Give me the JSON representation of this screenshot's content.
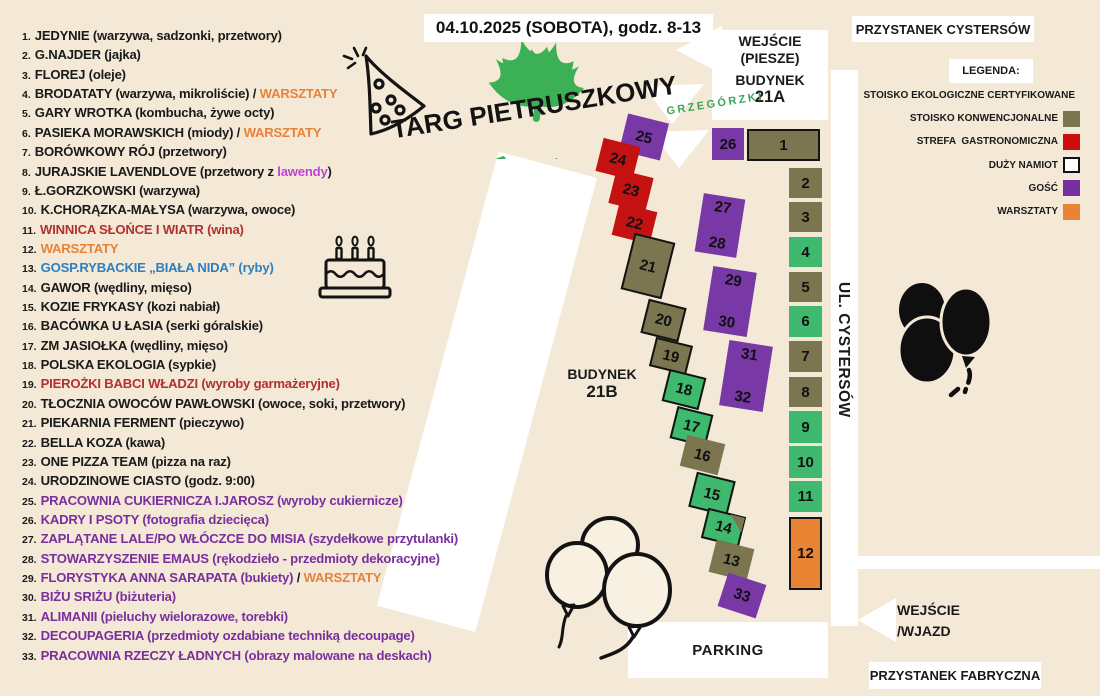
{
  "banner": {
    "text": "04.10.2025 (SOBOTA), godz. 8-13"
  },
  "logo": {
    "title": "TARG PIETRUSZKOWY",
    "subtitle": "GRZEGÓRZKI"
  },
  "vendors": [
    {
      "num": "1.",
      "segments": [
        [
          "JEDYNIE (warzywa, sadzonki, przetwory)",
          "k"
        ]
      ]
    },
    {
      "num": "2.",
      "segments": [
        [
          "G.NAJDER (jajka)",
          "k"
        ]
      ]
    },
    {
      "num": "3.",
      "segments": [
        [
          "FLOREJ (oleje)",
          "k"
        ]
      ]
    },
    {
      "num": "4.",
      "segments": [
        [
          "BRODATATY (warzywa, mikroliście) / ",
          "k"
        ],
        [
          "WARSZTATY",
          "o"
        ]
      ]
    },
    {
      "num": "5.",
      "segments": [
        [
          "GARY WROTKA (kombucha, żywe octy)",
          "k"
        ]
      ]
    },
    {
      "num": "6.",
      "segments": [
        [
          "PASIEKA MORAWSKICH (miody) / ",
          "k"
        ],
        [
          "WARSZTATY",
          "o"
        ]
      ]
    },
    {
      "num": "7.",
      "segments": [
        [
          "BORÓWKOWY RÓJ (przetwory)",
          "k"
        ]
      ]
    },
    {
      "num": "8.",
      "segments": [
        [
          "JURAJSKIE LAVENDLOVE (przetwory z ",
          "k"
        ],
        [
          "lawendy",
          "m"
        ],
        [
          ")",
          "k"
        ]
      ]
    },
    {
      "num": "9.",
      "segments": [
        [
          "Ł.GORZKOWSKI (warzywa)",
          "k"
        ]
      ]
    },
    {
      "num": "10.",
      "segments": [
        [
          "K.CHORĄZKA-MAŁYSA (warzywa, owoce)",
          "k"
        ]
      ]
    },
    {
      "num": "11.",
      "segments": [
        [
          "WINNICA SŁOŃCE I WIATR (wina)",
          "r"
        ]
      ]
    },
    {
      "num": "12.",
      "segments": [
        [
          "WARSZTATY",
          "o"
        ]
      ]
    },
    {
      "num": "13.",
      "segments": [
        [
          "GOSP.RYBACKIE „BIAŁA NIDA” (ryby)",
          "b"
        ]
      ]
    },
    {
      "num": "14.",
      "segments": [
        [
          "GAWOR (wędliny, mięso)",
          "k"
        ]
      ]
    },
    {
      "num": "15.",
      "segments": [
        [
          "KOZIE FRYKASY (kozi nabiał)",
          "k"
        ]
      ]
    },
    {
      "num": "16.",
      "segments": [
        [
          "BACÓWKA U ŁASIA (serki góralskie)",
          "k"
        ]
      ]
    },
    {
      "num": "17.",
      "segments": [
        [
          "ZM JASIOŁKA (wędliny, mięso)",
          "k"
        ]
      ]
    },
    {
      "num": "18.",
      "segments": [
        [
          "POLSKA EKOLOGIA (sypkie)",
          "k"
        ]
      ]
    },
    {
      "num": "19.",
      "segments": [
        [
          "PIEROŻKI BABCI WŁADZI (wyroby garmażeryjne)",
          "r"
        ]
      ]
    },
    {
      "num": "20.",
      "segments": [
        [
          "TŁOCZNIA OWOCÓW PAWŁOWSKI (owoce, soki, przetwory)",
          "k"
        ]
      ]
    },
    {
      "num": "21.",
      "segments": [
        [
          "PIEKARNIA FERMENT (pieczywo)",
          "k"
        ]
      ]
    },
    {
      "num": "22.",
      "segments": [
        [
          "BELLA KOZA (kawa)",
          "k"
        ]
      ]
    },
    {
      "num": "23.",
      "segments": [
        [
          "ONE PIZZA TEAM (pizza na raz)",
          "k"
        ]
      ]
    },
    {
      "num": "24.",
      "segments": [
        [
          "URODZINOWE CIASTO (godz. 9:00)",
          "k"
        ]
      ]
    },
    {
      "num": "25.",
      "segments": [
        [
          "PRACOWNIA CUKIERNICZA I.JAROSZ (wyroby cukiernicze)",
          "p"
        ]
      ]
    },
    {
      "num": "26.",
      "segments": [
        [
          "KADRY I PSOTY (fotografia dziecięca)",
          "p"
        ]
      ]
    },
    {
      "num": "27.",
      "segments": [
        [
          "ZAPLĄTANE LALE/PO WŁÓCZCE DO MISIA (szydełkowe przytulanki)",
          "p"
        ]
      ]
    },
    {
      "num": "28.",
      "segments": [
        [
          "STOWARZYSZENIE EMAUS (rękodzieło - przedmioty dekoracyjne)",
          "p"
        ]
      ]
    },
    {
      "num": "29.",
      "segments": [
        [
          "FLORYSTYKA ANNA SARAPATA (bukiety) ",
          "p"
        ],
        [
          "/ ",
          "k"
        ],
        [
          "WARSZTATY",
          "o"
        ]
      ]
    },
    {
      "num": "30.",
      "segments": [
        [
          "BIŻU SRIŻU (biżuteria)",
          "p"
        ]
      ]
    },
    {
      "num": "31.",
      "segments": [
        [
          "ALIMANII (pieluchy wielorazowe, torebki)",
          "p"
        ]
      ]
    },
    {
      "num": "32.",
      "segments": [
        [
          "DECOUPAGERIA (przedmioty ozdabiane techniką decoupage)",
          "p"
        ]
      ]
    },
    {
      "num": "33.",
      "segments": [
        [
          "PRACOWNIA RZECZY ŁADNYCH (obrazy malowane na deskach)",
          "p"
        ]
      ]
    }
  ],
  "legend": {
    "title": "LEGENDA:",
    "items": [
      {
        "label": "STOISKO EKOLOGICZNE CERTYFIKOWANE",
        "swatch": "eco"
      },
      {
        "label": "STOISKO KONWENCJONALNE",
        "swatch": "conventional"
      },
      {
        "label": "STREFA  GASTRONOMICZNA",
        "swatch": "gastro"
      },
      {
        "label": "DUŻY NAMIOT",
        "swatch": "tent"
      },
      {
        "label": "GOŚĆ",
        "swatch": "guest"
      },
      {
        "label": "WARSZTATY",
        "swatch": "workshop"
      }
    ]
  },
  "map": {
    "stop_top": "PRZYSTANEK CYSTERSÓW",
    "stop_bottom": "PRZYSTANEK FABRYCZNA",
    "entrance_pedestrian": {
      "line1": "WEJŚCIE",
      "line2": "(PIESZE)"
    },
    "building_a": {
      "line1": "BUDYNEK",
      "line2": "21A"
    },
    "building_b": {
      "line1": "BUDYNEK",
      "line2": "21B"
    },
    "street": "UL. CYSTERSÓW",
    "parking": "PARKING",
    "entrance_drive": {
      "line1": "WEJŚCIE",
      "line2": "/WJAZD"
    },
    "stalls": [
      {
        "n": "25",
        "type": "guest"
      },
      {
        "n": "24",
        "type": "gastro"
      },
      {
        "n": "23",
        "type": "gastro"
      },
      {
        "n": "22",
        "type": "gastro"
      },
      {
        "n": "21",
        "type": "conventional",
        "tent": true
      },
      {
        "n": "20",
        "type": "conventional",
        "tent": true
      },
      {
        "n": "19",
        "type": "conventional",
        "tent": true
      },
      {
        "n": "18",
        "type": "eco",
        "tent": true
      },
      {
        "n": "17",
        "type": "eco",
        "tent": true
      },
      {
        "n": "16",
        "type": "conventional"
      },
      {
        "n": "15",
        "type": "eco",
        "tent": true
      },
      {
        "n": "14",
        "type": "eco",
        "tent": true
      },
      {
        "n": "13",
        "type": "conventional"
      },
      {
        "n": "33",
        "type": "guest"
      },
      {
        "n": "26",
        "type": "guest"
      },
      {
        "n": "1",
        "type": "conventional",
        "tent": true
      },
      {
        "n": "2",
        "type": "conventional"
      },
      {
        "n": "3",
        "type": "conventional"
      },
      {
        "n": "4",
        "type": "eco"
      },
      {
        "n": "5",
        "type": "conventional"
      },
      {
        "n": "6",
        "type": "eco"
      },
      {
        "n": "7",
        "type": "conventional"
      },
      {
        "n": "8",
        "type": "conventional"
      },
      {
        "n": "9",
        "type": "eco"
      },
      {
        "n": "10",
        "type": "eco"
      },
      {
        "n": "11",
        "type": "eco"
      },
      {
        "n": "12",
        "type": "workshop",
        "tent": true
      },
      {
        "n": "27",
        "n2": "28",
        "type": "guest"
      },
      {
        "n": "29",
        "n2": "30",
        "type": "guest"
      },
      {
        "n": "31",
        "n2": "32",
        "type": "guest"
      }
    ]
  },
  "palette": {
    "background": "#f3e9d6",
    "eco_green": "#3eb96e",
    "conventional_olive": "#7c7650",
    "gastro_red": "#c41212",
    "guest_purple": "#7838a6",
    "workshop_orange": "#e98434",
    "workshop_text_orange": "#e8823a",
    "wine_red_text": "#b23030",
    "fish_blue_text": "#2d7fc3",
    "craft_purple_text": "#7a2f9e",
    "lavender_magenta_text": "#bd42d6",
    "logo_green": "#3aa655"
  }
}
